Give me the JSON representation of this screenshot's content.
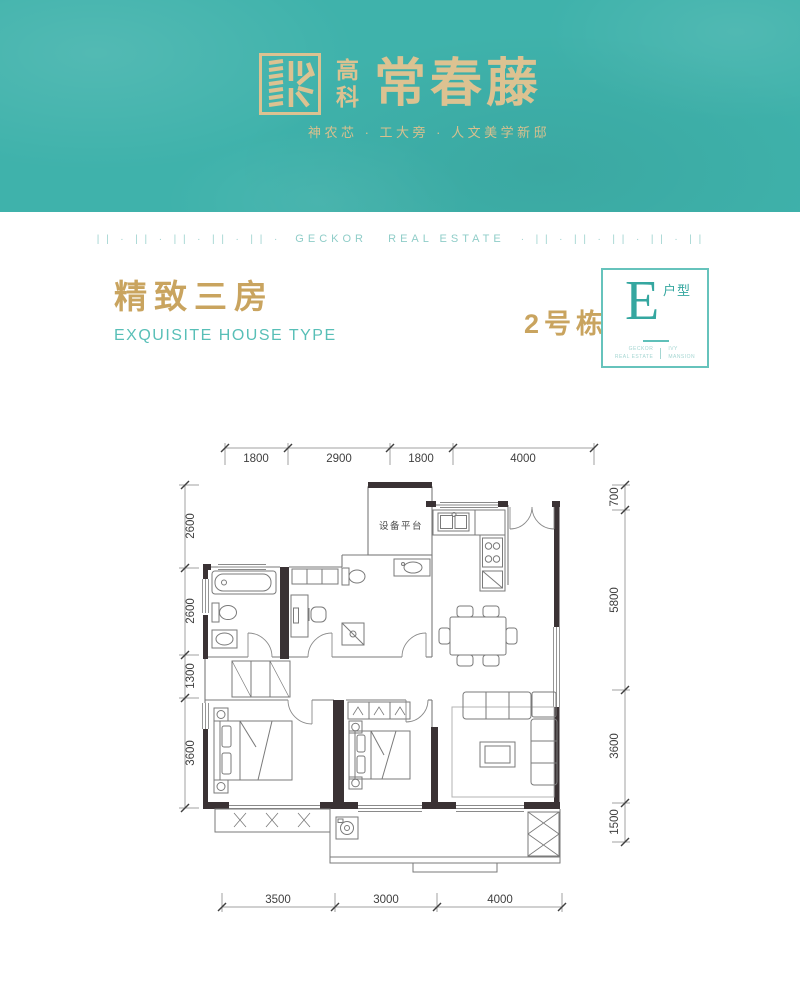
{
  "colors": {
    "brand_teal": "#3fb2ab",
    "logo_gold": "#dcc291",
    "title_gold": "#c9a45f",
    "accent_teal": "#58bfb7",
    "light_teal": "#9ed3cf",
    "wall_dark": "#3a3234"
  },
  "header": {
    "logo_prefix": "高科",
    "logo_name": "常春藤",
    "tagline": "神农芯 · 工大旁 · 人文美学新邸"
  },
  "divider": {
    "pattern_left": "| |  ·  | |  ·  | |  ·  | |  ·  | |  ·",
    "label": "GECKOR   REAL ESTATE",
    "pattern_right": "·  | |  ·  | |  ·  | |  ·  | |  ·  | |"
  },
  "section": {
    "title_cn": "精致三房",
    "title_en": "EXQUISITE HOUSE TYPE",
    "building": "2号栋",
    "unit_letter": "E",
    "unit_label": "户型",
    "badge_footer_left_line1": "GECKOR",
    "badge_footer_left_line2": "REAL ESTATE",
    "badge_footer_right_line1": "IVY",
    "badge_footer_right_line2": "MANSION"
  },
  "plan": {
    "equipment_label": "设备平台",
    "dims": {
      "top": [
        "1800",
        "2900",
        "1800",
        "4000"
      ],
      "bottom": [
        "3500",
        "3000",
        "4000"
      ],
      "left": [
        "2600",
        "2600",
        "1300",
        "3600"
      ],
      "right": [
        "700",
        "5800",
        "3600",
        "1500"
      ]
    }
  }
}
